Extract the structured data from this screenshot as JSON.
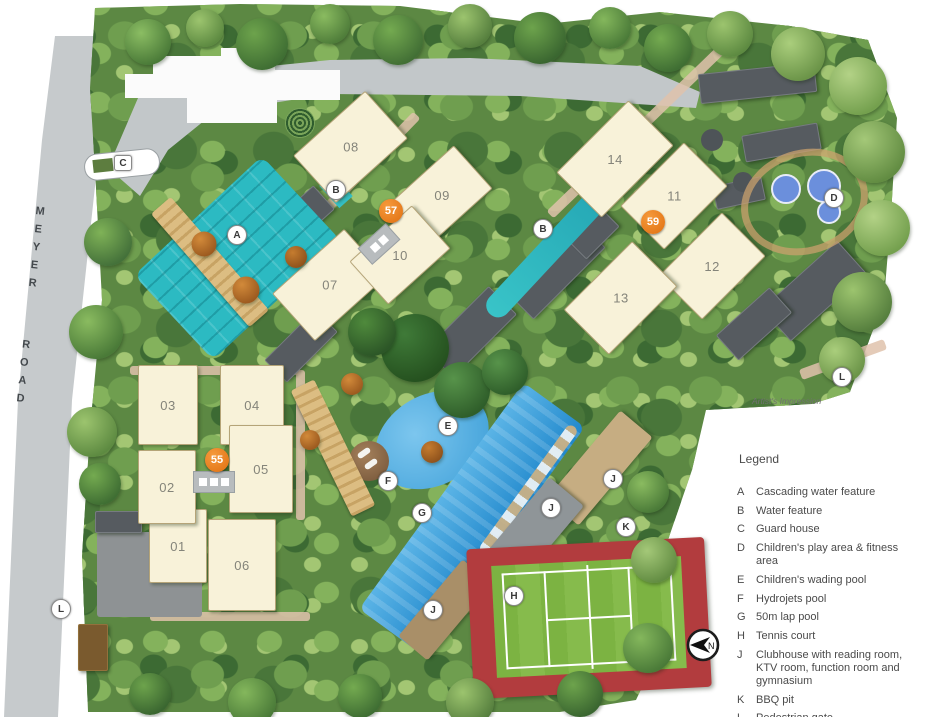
{
  "plan": {
    "road_label": "MEYER ROAD",
    "caption": "Artist's Impression",
    "buildings": [
      {
        "label": "01"
      },
      {
        "label": "02"
      },
      {
        "label": "03"
      },
      {
        "label": "04"
      },
      {
        "label": "05"
      },
      {
        "label": "06"
      },
      {
        "label": "07"
      },
      {
        "label": "08"
      },
      {
        "label": "09"
      },
      {
        "label": "10"
      },
      {
        "label": "11"
      },
      {
        "label": "12"
      },
      {
        "label": "13"
      },
      {
        "label": "14"
      }
    ],
    "address_badges": [
      {
        "label": "55"
      },
      {
        "label": "57"
      },
      {
        "label": "59"
      }
    ],
    "amenity_markers": [
      {
        "label": "A"
      },
      {
        "label": "B"
      },
      {
        "label": "B"
      },
      {
        "label": "C"
      },
      {
        "label": "D"
      },
      {
        "label": "E"
      },
      {
        "label": "F"
      },
      {
        "label": "G"
      },
      {
        "label": "H"
      },
      {
        "label": "J"
      },
      {
        "label": "J"
      },
      {
        "label": "J"
      },
      {
        "label": "K"
      },
      {
        "label": "L"
      },
      {
        "label": "L"
      }
    ]
  },
  "legend": {
    "title": "Legend",
    "items": [
      {
        "key": "A",
        "label": "Cascading water feature"
      },
      {
        "key": "B",
        "label": "Water feature"
      },
      {
        "key": "C",
        "label": "Guard house"
      },
      {
        "key": "D",
        "label": "Children's play area & fitness area"
      },
      {
        "key": "E",
        "label": "Children's wading pool"
      },
      {
        "key": "F",
        "label": "Hydrojets pool"
      },
      {
        "key": "G",
        "label": "50m lap pool"
      },
      {
        "key": "H",
        "label": "Tennis court"
      },
      {
        "key": "J",
        "label": "Clubhouse with reading room, KTV room, function room and gymnasium"
      },
      {
        "key": "K",
        "label": "BBQ pit"
      },
      {
        "key": "L",
        "label": "Pedestrian gate"
      }
    ]
  },
  "compass": {
    "label": "N"
  },
  "colors": {
    "site_green": "#5c8843",
    "road_gray": "#c6cacc",
    "building_cream": "#f8f2d9",
    "water_teal": "#2cbac2",
    "pool_blue": "#4aa8e0",
    "tennis_red": "#b23c3e",
    "court_green": "#7cb342",
    "badge_orange": "#e8760f",
    "play_area_blue": "#6b8fdc"
  }
}
